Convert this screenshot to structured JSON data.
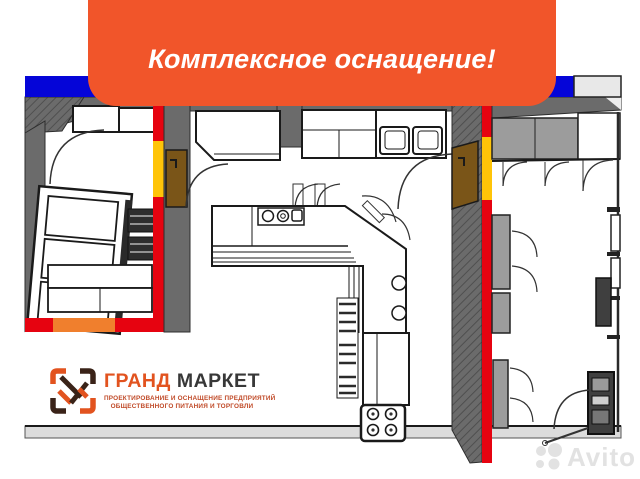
{
  "banner": {
    "text": "Комплексное оснащение!",
    "bg_color": "#F1552A",
    "text_color": "#FFFFFF"
  },
  "header_bars": {
    "blue_color": "#0505D8",
    "gray_segment_color": "#E8E8E8"
  },
  "plan_colors": {
    "wall_dark_gray": "#6B6B6B",
    "wall_red": "#E60310",
    "wall_yellow": "#FFC408",
    "wall_orange_segment": "#F07F2D",
    "door_brown": "#7A5518",
    "cabinet_gray": "#9C9C9C",
    "floor_light_gray": "#DCDCDC"
  },
  "logo": {
    "brand_primary": "ГРАНД",
    "brand_secondary": "МАРКЕТ",
    "tagline_line1": "ПРОЕКТИРОВАНИЕ И ОСНАЩЕНИЕ ПРЕДПРИЯТИЙ",
    "tagline_line2": "ОБЩЕСТВЕННОГО ПИТАНИЯ И ТОРГОВЛИ",
    "accent_color": "#E2531F",
    "dark_color": "#3A2318"
  },
  "watermark": {
    "text": "Avito",
    "color": "#E2E2E2"
  }
}
